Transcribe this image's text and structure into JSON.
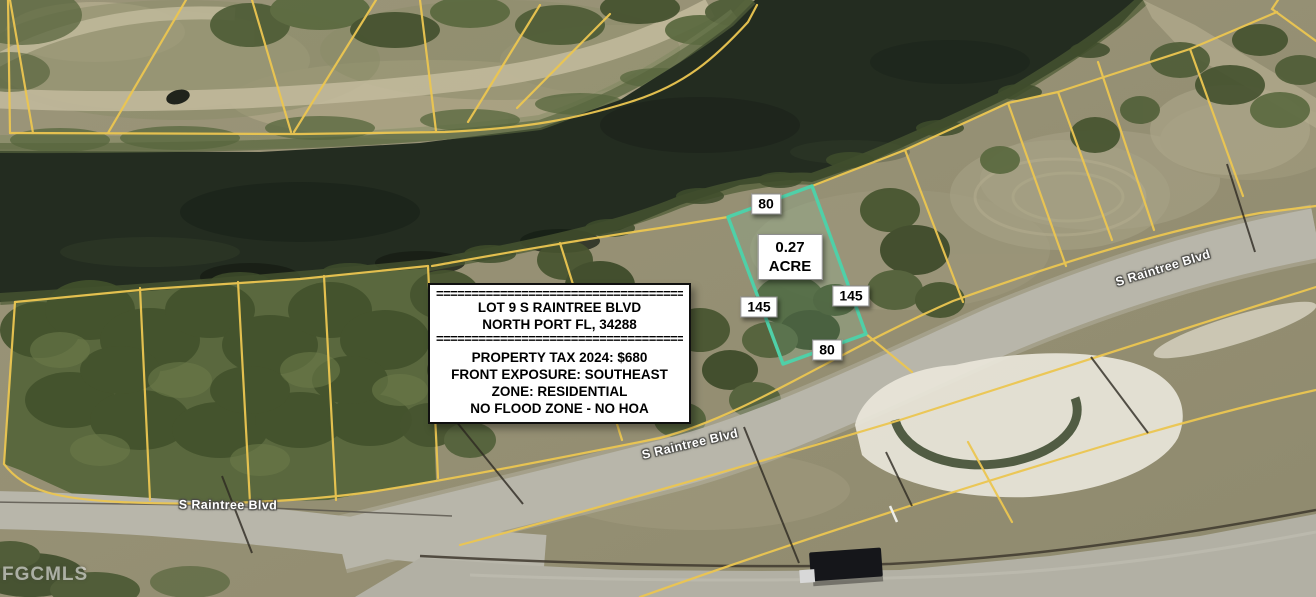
{
  "property": {
    "divider": "========================================",
    "address_line1": "LOT 9 S RAINTREE BLVD",
    "address_line2": "NORTH PORT FL, 34288",
    "details": [
      "PROPERTY TAX 2024: $680",
      "FRONT EXPOSURE: SOUTHEAST",
      "ZONE: RESIDENTIAL",
      "NO FLOOD ZONE - NO HOA"
    ]
  },
  "lot": {
    "area_value": "0.27",
    "area_unit": "ACRE",
    "dim_top": "80",
    "dim_right": "145",
    "dim_bottom": "80",
    "dim_left": "145"
  },
  "streets": [
    {
      "text": "S Raintree Blvd"
    },
    {
      "text": "S Raintree Blvd"
    },
    {
      "text": "S Raintree Blvd"
    }
  ],
  "watermark": "FGCMLS",
  "colors": {
    "parcel_line_yellow": "#ecc651",
    "subject_lot_teal": "#4fd0a8",
    "canal_water": "#232c20",
    "label_background": "#ffffff"
  }
}
